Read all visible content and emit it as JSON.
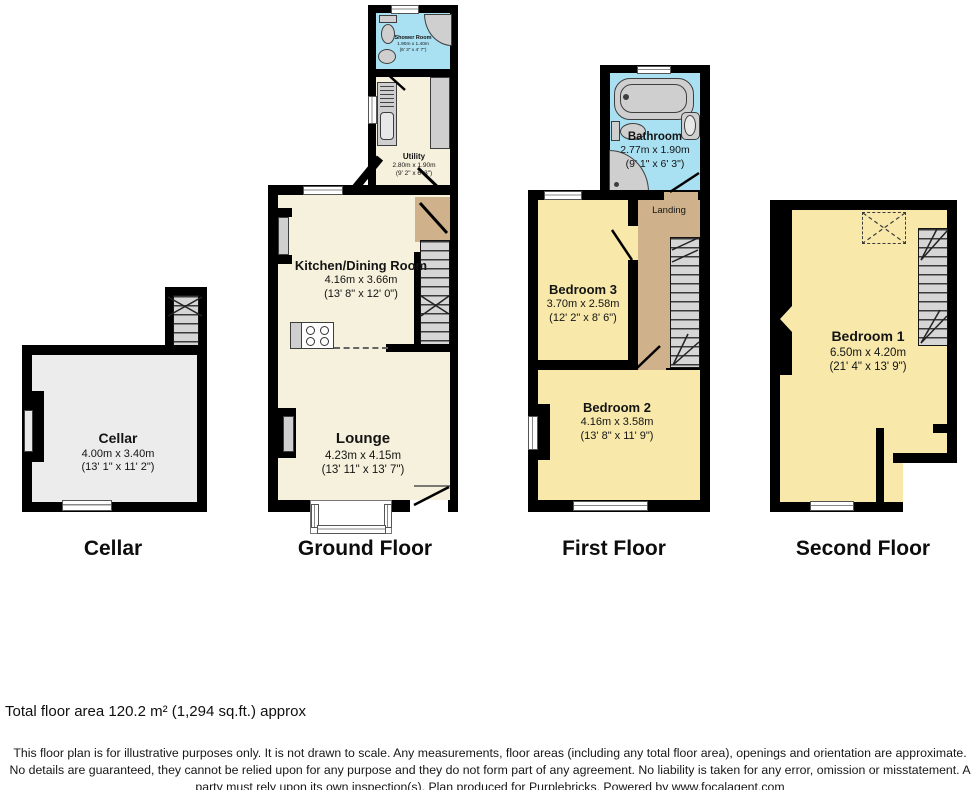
{
  "floors": {
    "cellar": {
      "label": "Cellar"
    },
    "ground": {
      "label": "Ground Floor"
    },
    "first": {
      "label": "First Floor"
    },
    "second": {
      "label": "Second Floor"
    }
  },
  "rooms": {
    "shower_room": {
      "name": "Shower Room",
      "metric": "1.90m x 1.40m",
      "imperial": "(6' 3\" x 4' 7\")"
    },
    "utility": {
      "name": "Utility",
      "metric": "2.80m x 1.90m",
      "imperial": "(9' 2\" x 6' 3\")"
    },
    "kitchen_dining": {
      "name": "Kitchen/Dining Room",
      "metric": "4.16m x 3.66m",
      "imperial": "(13' 8\" x 12' 0\")"
    },
    "lounge": {
      "name": "Lounge",
      "metric": "4.23m x 4.15m",
      "imperial": "(13' 11\" x 13' 7\")"
    },
    "cellar": {
      "name": "Cellar",
      "metric": "4.00m x 3.40m",
      "imperial": "(13' 1\" x 11' 2\")"
    },
    "bathroom": {
      "name": "Bathroom",
      "metric": "2.77m x 1.90m",
      "imperial": "(9' 1\" x 6' 3\")"
    },
    "landing": {
      "name": "Landing"
    },
    "bedroom3": {
      "name": "Bedroom 3",
      "metric": "3.70m x 2.58m",
      "imperial": "(12' 2\" x 8' 6\")"
    },
    "bedroom2": {
      "name": "Bedroom 2",
      "metric": "4.16m x 3.58m",
      "imperial": "(13' 8\" x 11' 9\")"
    },
    "bedroom1": {
      "name": "Bedroom 1",
      "metric": "6.50m x 4.20m",
      "imperial": "(21' 4\" x 13' 9\")"
    }
  },
  "footer": {
    "total_area": "Total floor area 120.2 m² (1,294 sq.ft.) approx",
    "disclaimer": "This floor plan is for illustrative purposes only. It is not drawn to scale. Any measurements, floor areas (including any total floor area), openings and orientation are approximate. No details are guaranteed, they cannot be relied upon for any purpose and they do not form part of any agreement. No liability is taken for any error, omission or misstatement. A party must rely upon its own inspection(s). Plan produced for Purplebricks. Powered by www.focalagent.com"
  },
  "colors": {
    "wall": "#000000",
    "bedroom_fill": "#f8e9ab",
    "living_fill": "#f5f1dc",
    "wet_room_fill": "#a9e0f2",
    "landing_fill": "#cfb28c",
    "cellar_fill": "#ececec",
    "stairs_fill": "#d6d6d6"
  }
}
